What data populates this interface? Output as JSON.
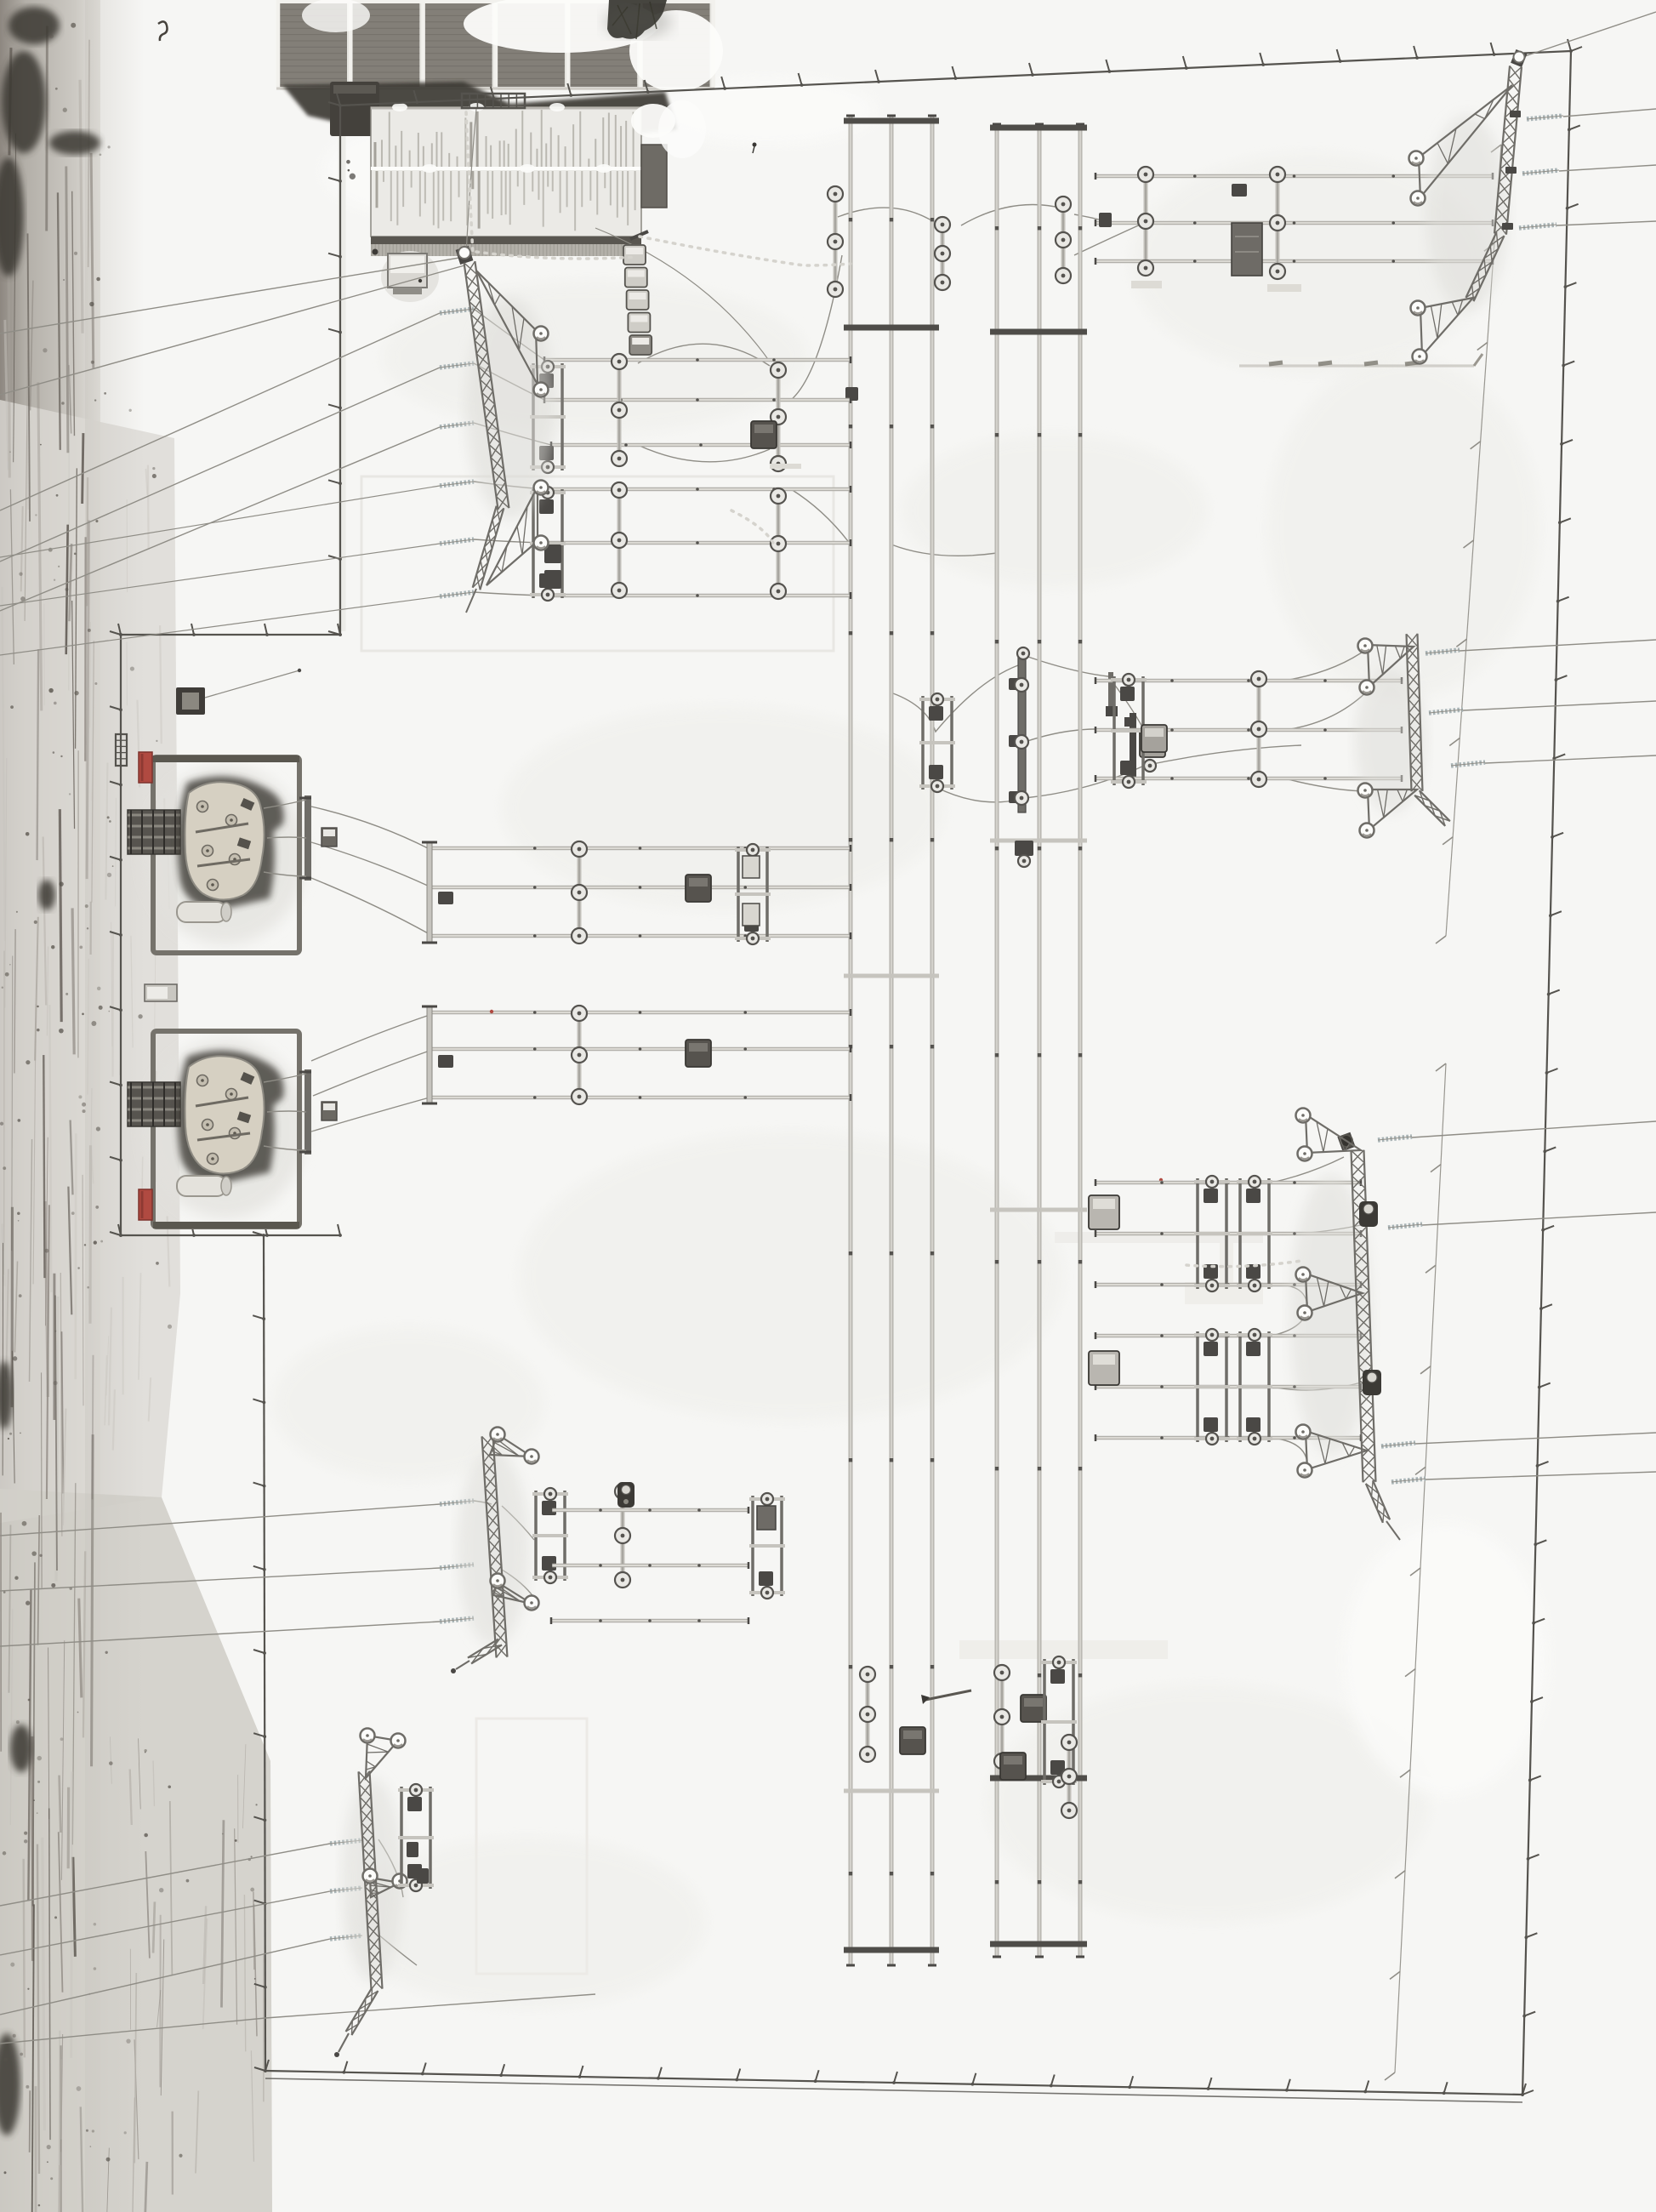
{
  "scene": {
    "type": "aerial-photograph",
    "description": "Top-down winter drone view of a snow-covered high-voltage electrical substation with a dirt access road along the left edge",
    "season": "winter",
    "ground_cover": "snow",
    "no_visible_text": true
  },
  "colors": {
    "snow": "#f6f6f4",
    "snow_shadow": "#e9e9e6",
    "snow_white": "#fcfcfa",
    "road_light": "#d8d6d1",
    "road_mid": "#a9a49d",
    "road_dark": "#6b655e",
    "mud_dark": "#3b3731",
    "steel_dark": "#4a4845",
    "steel_mid": "#6f6d68",
    "rail_light": "#c9c7c1",
    "fence": "#55534e",
    "wire": "#8f8d86",
    "insulator_blue": "#a9b4b6",
    "firewall_red": "#b04a41",
    "roof_snow": "#ebeae6",
    "roof_streak": "#a19e96",
    "eave_dark": "#595650",
    "panel_cell": "#837f78",
    "panel_frame": "#e6e5e0",
    "melt_dark": "#3e3a34",
    "transformer_body": "#d6d0c2"
  },
  "objects": {
    "road": {
      "name": "access-road",
      "position": "left-edge",
      "texture": "tire-tracks-and-mud"
    },
    "buildings": [
      {
        "name": "solar-roof-building",
        "position": "top-left",
        "panels": 6
      },
      {
        "name": "control-building",
        "position": "upper-left",
        "roof": "snow-with-melt-streaks"
      },
      {
        "name": "utility-cabinet",
        "position": "below-control-building"
      }
    ],
    "transformer_bays": [
      {
        "name": "transformer-bay-1",
        "firewall": "red",
        "radiator": true
      },
      {
        "name": "transformer-bay-2",
        "firewall": "red",
        "radiator": true
      }
    ],
    "gantry_towers": [
      {
        "name": "gantry-tower-top-left"
      },
      {
        "name": "gantry-tower-top-right"
      },
      {
        "name": "gantry-tower-right-middle"
      },
      {
        "name": "gantry-tower-right-lower"
      },
      {
        "name": "gantry-tower-bottom-left-1"
      },
      {
        "name": "gantry-tower-bottom-left-2"
      }
    ],
    "busbar_corridors": [
      {
        "name": "busbar-corridor-a",
        "rails": 3
      },
      {
        "name": "busbar-corridor-b",
        "rails": 3
      }
    ],
    "feeder_bays": {
      "left_rows": 4,
      "right_rows": 4,
      "conductors_per_bay": 3
    },
    "fence": {
      "perimeter": true,
      "gates": 2,
      "annex": "transformer-yard-west"
    },
    "vegetation": [
      {
        "name": "tree-canopy",
        "position": "top-center"
      }
    ]
  }
}
